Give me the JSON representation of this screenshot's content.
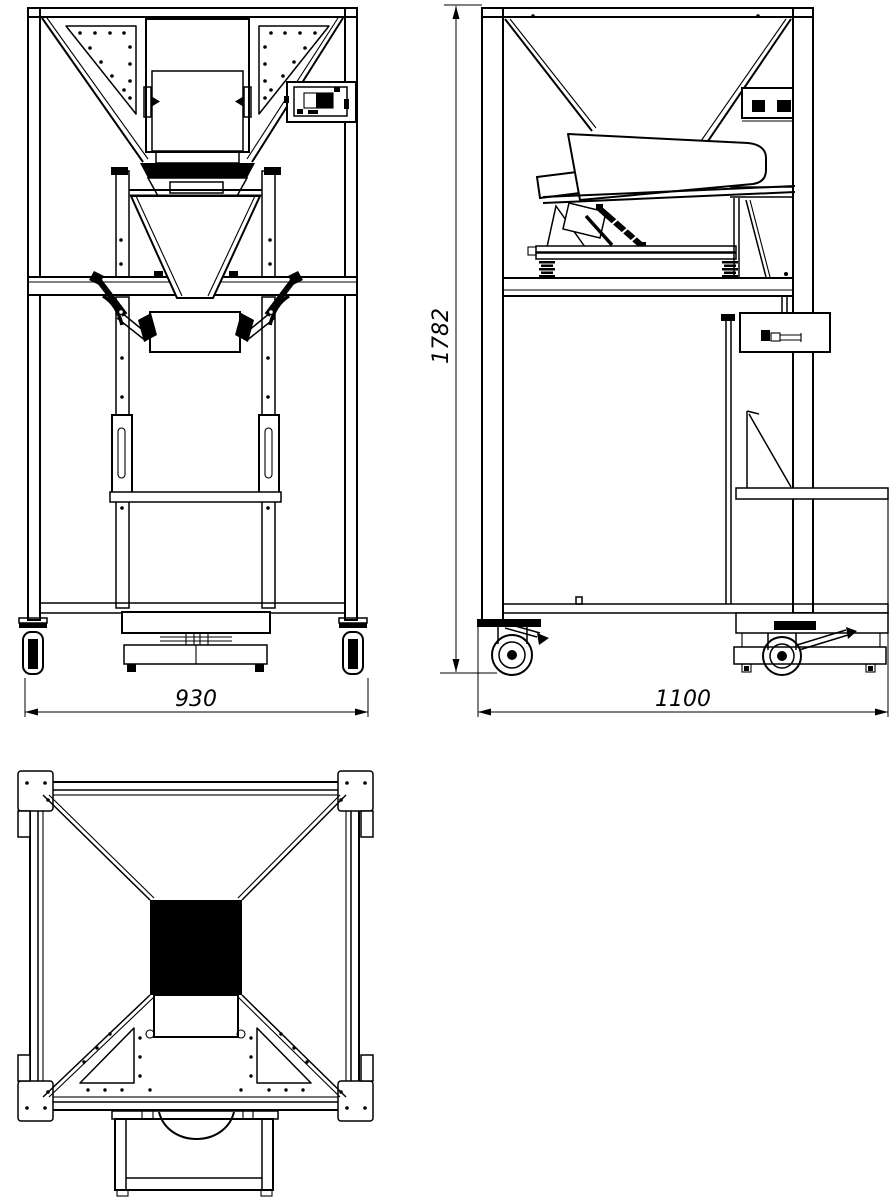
{
  "drawing": {
    "background_color": "#ffffff",
    "line_color": "#000000",
    "dimensions": {
      "overall_height": "1782",
      "front_width": "930",
      "side_depth": "1100"
    }
  }
}
